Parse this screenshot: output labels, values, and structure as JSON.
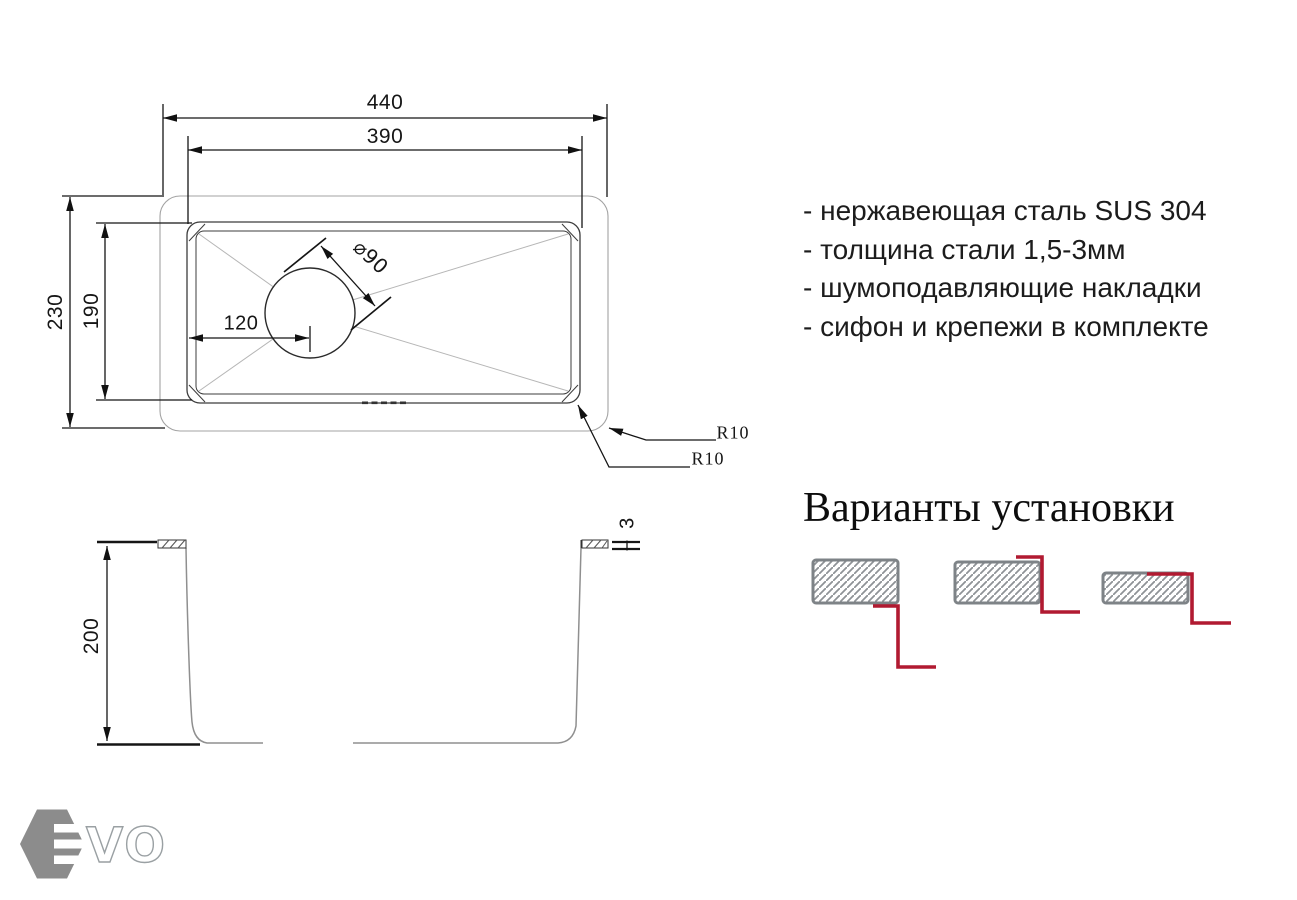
{
  "top_view": {
    "dims": {
      "overall_width": "440",
      "bowl_width": "390",
      "overall_depth": "230",
      "bowl_depth": "190",
      "drain_offset": "120",
      "drain_diameter": "⌀90",
      "outer_corner_radius": "R10",
      "bowl_corner_radius": "R10"
    }
  },
  "side_view": {
    "dims": {
      "bowl_height": "200",
      "steel_thickness": "3"
    }
  },
  "specs": {
    "items": [
      "- нержавеющая сталь SUS 304",
      "- толщина стали 1,5-3мм",
      "- шумоподавляющие накладки",
      "- сифон и крепежи в комплекте"
    ]
  },
  "installation": {
    "title": "Варианты установки"
  },
  "logo": {
    "outline_text": "VO"
  },
  "colors": {
    "accent_red": "#b11a31",
    "hatch_border_gray": "#7e8387",
    "hatch_line_gray": "#8e9296",
    "logo_gray": "#8c8c8c",
    "line_black": "#151515",
    "profile_gray": "#8f8f8f"
  }
}
